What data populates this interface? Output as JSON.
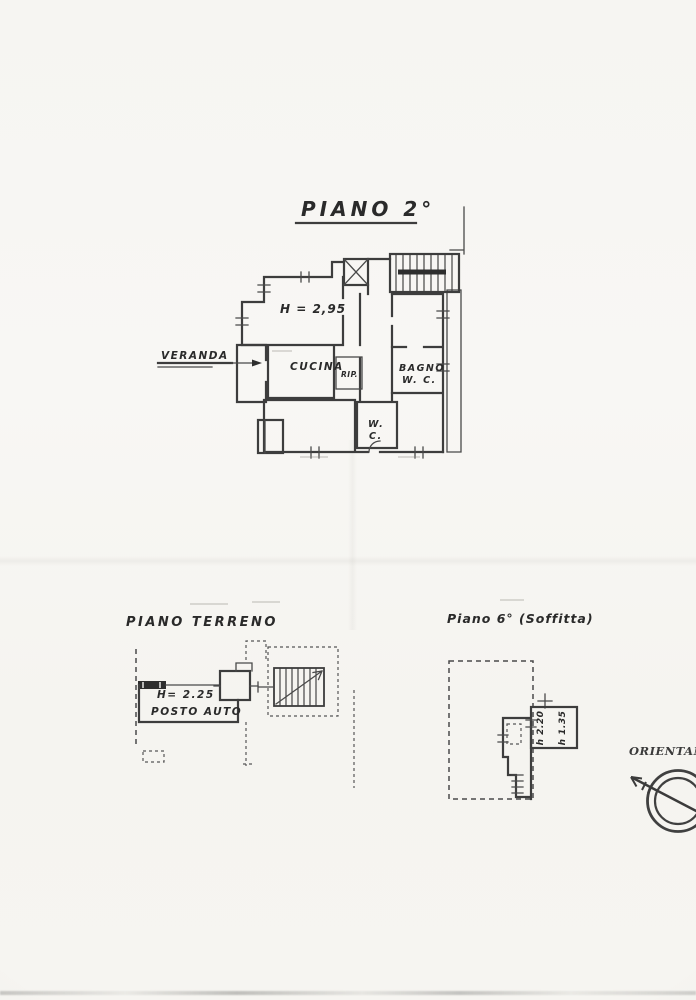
{
  "sheet": {
    "second_floor": {
      "title": "PIANO 2°",
      "labels": {
        "ceiling_height": "H = 2,95",
        "kitchen": "CUCINA",
        "storage": "RIP.",
        "bath_line1": "BAGNO",
        "bath_line2": "W. C.",
        "wc_line1": "W.",
        "wc_line2": "C.",
        "veranda": "VERANDA"
      }
    },
    "ground_floor": {
      "title": "PIANO TERRENO",
      "labels": {
        "ceiling_height": "H= 2.25",
        "parking": "POSTO AUTO"
      }
    },
    "attic": {
      "title": "Piano 6° (Soffitta)",
      "labels": {
        "height_inner": "h 2.20",
        "height_outer": "h 1.35"
      }
    },
    "compass": {
      "label": "ORIENTAME"
    },
    "colors": {
      "paper": "#f7f6f3",
      "ink": "#3a3a3a"
    }
  }
}
